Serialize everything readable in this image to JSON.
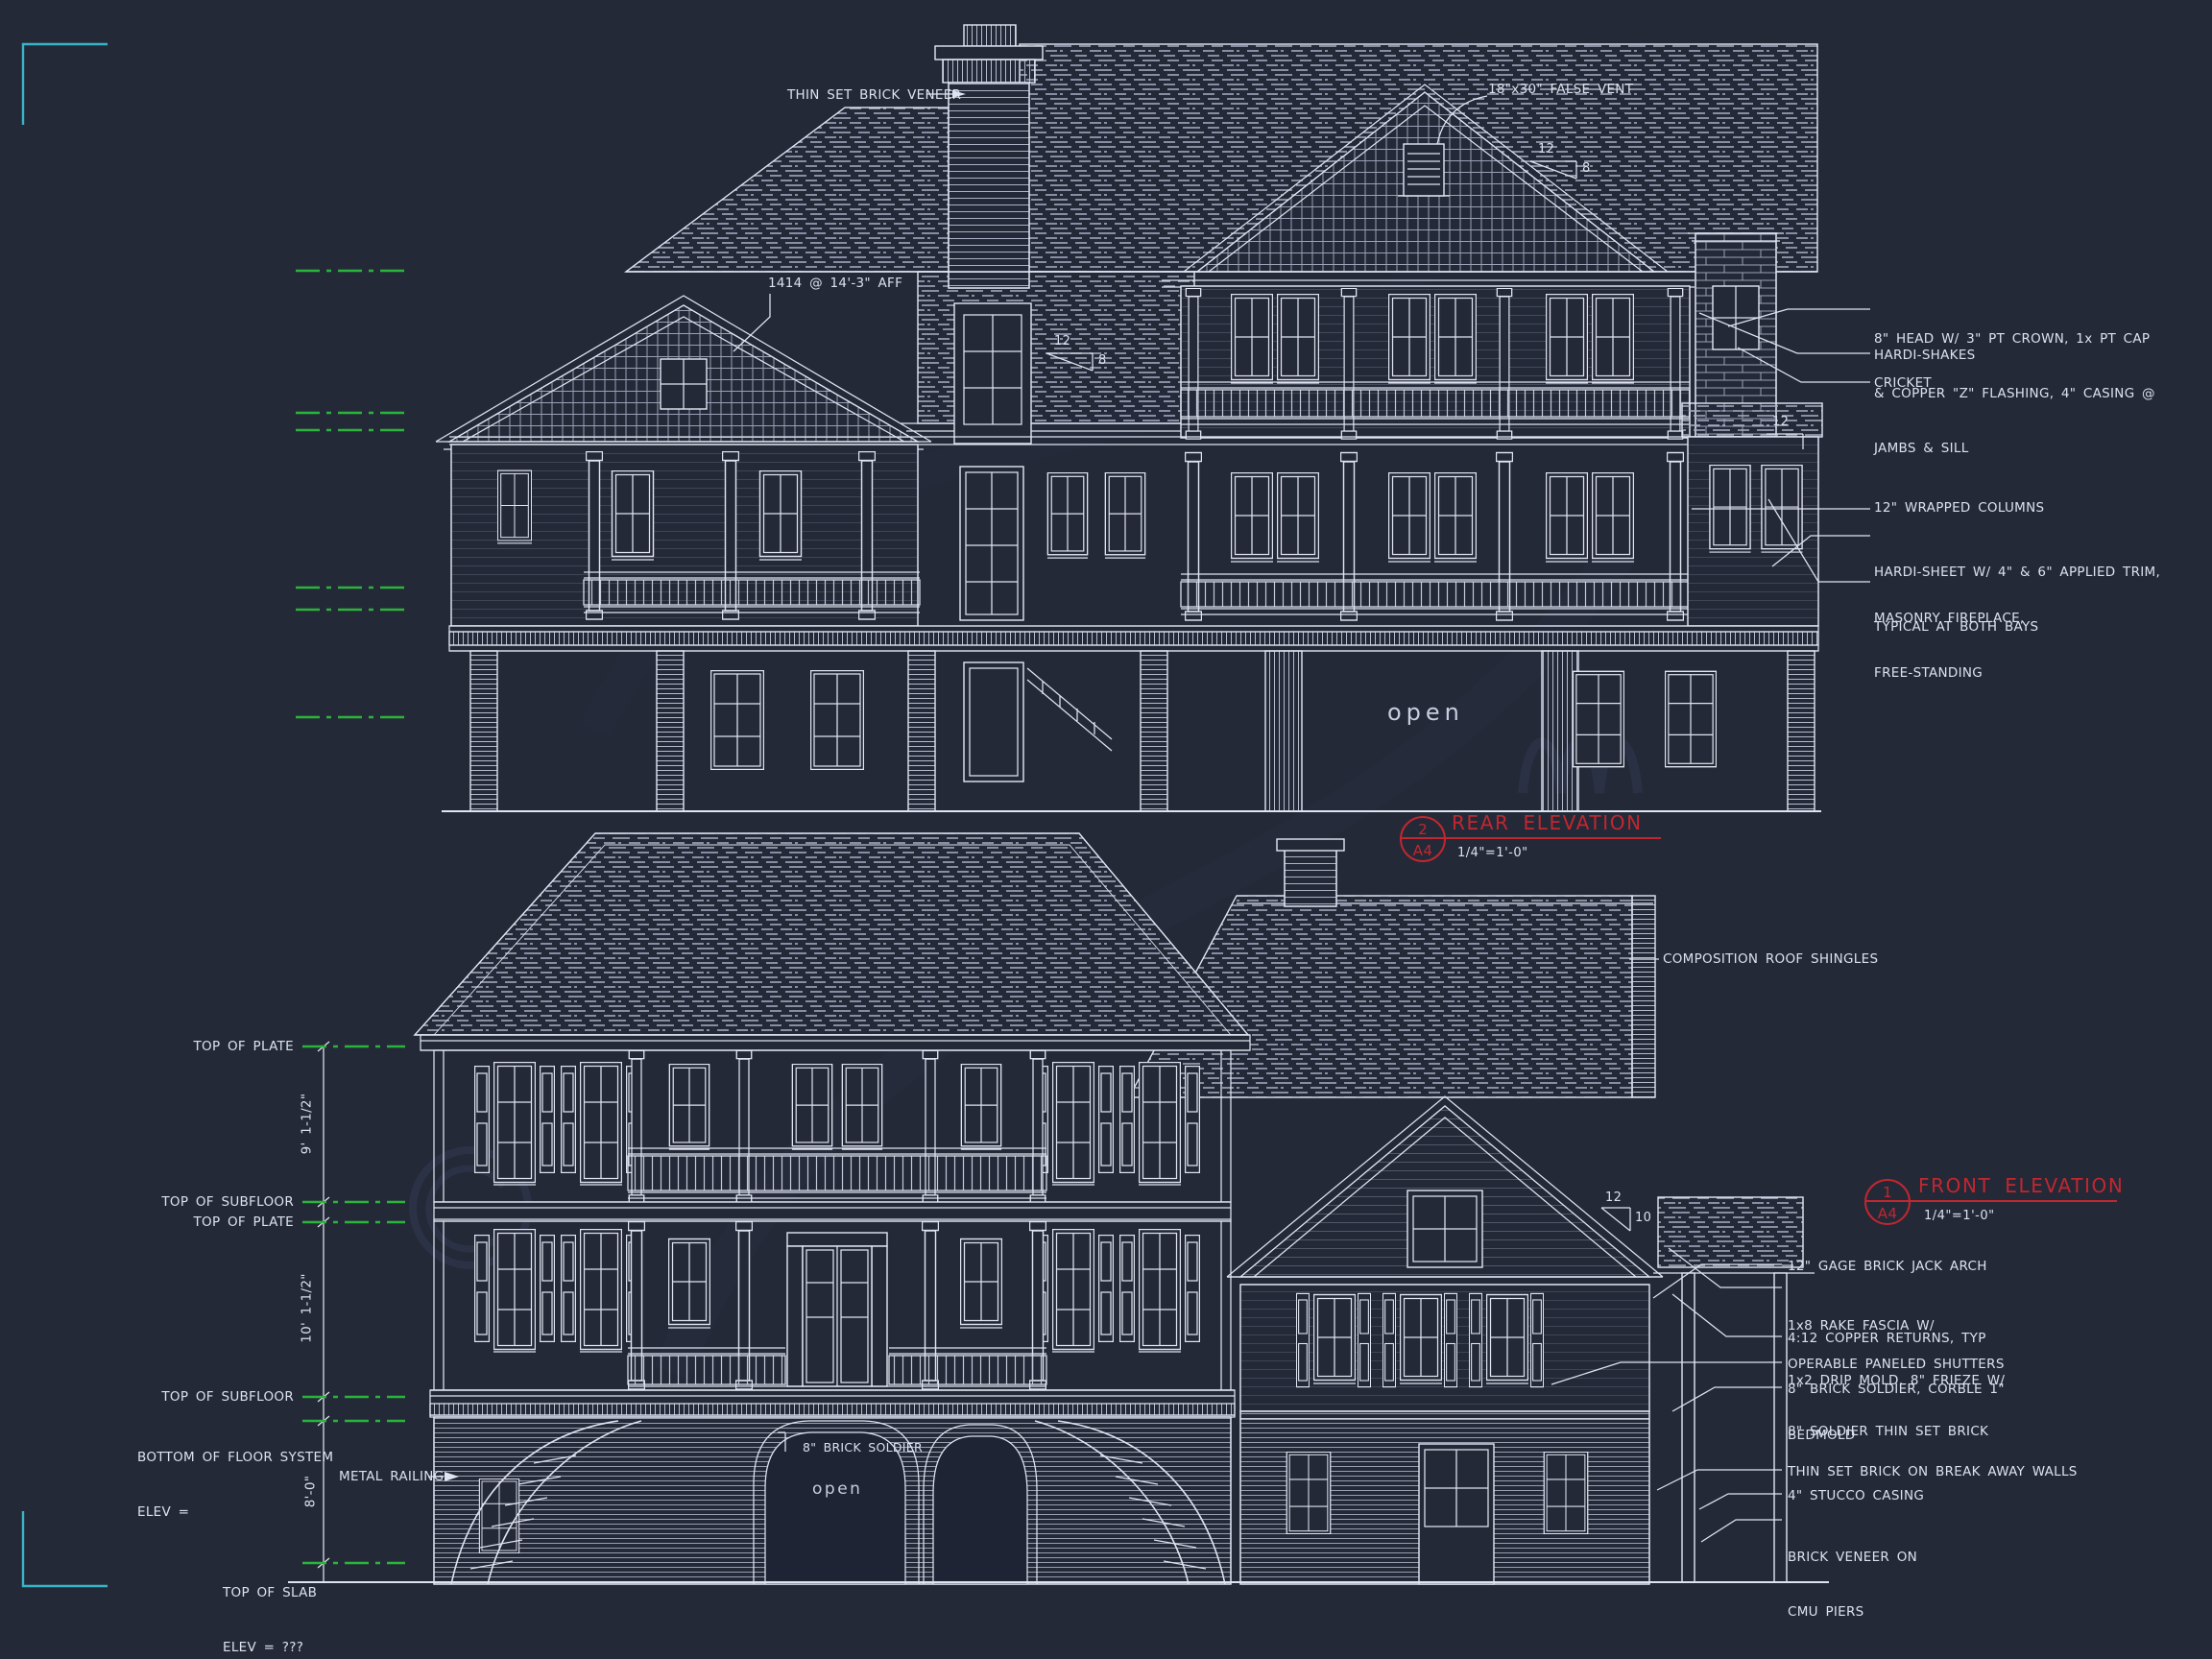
{
  "colors": {
    "background": "#242938",
    "ink": "#dfe4f0",
    "hatch": "#a7aec2",
    "datum_green": "#2bb43b",
    "title_red": "#c1272f",
    "corner_teal": "#38b4c8"
  },
  "rear": {
    "notes": {
      "brick_veneer": "THIN SET BRICK VENEER",
      "false_vent": "18\"x30\" FALSE VENT",
      "aff": "1414 @ 14'-3\" AFF",
      "open": "open"
    },
    "slopes": {
      "left_rise": "12",
      "left_run": "8",
      "top_rise": "12",
      "top_run": "8",
      "right_rise": "12"
    },
    "callouts": [
      {
        "lines": [
          "8\" HEAD W/ 3\" PT CROWN, 1x PT CAP",
          "& COPPER \"Z\" FLASHING, 4\" CASING @",
          "JAMBS & SILL"
        ]
      },
      {
        "lines": [
          "HARDI-SHAKES"
        ]
      },
      {
        "lines": [
          "CRICKET"
        ]
      },
      {
        "lines": [
          "12\" WRAPPED COLUMNS"
        ]
      },
      {
        "lines": [
          "HARDI-SHEET W/ 4\" & 6\" APPLIED TRIM,",
          "TYPICAL AT BOTH BAYS"
        ]
      },
      {
        "lines": [
          "MASONRY FIREPLACE,",
          "FREE-STANDING"
        ]
      }
    ],
    "title": {
      "number": "2",
      "sheet": "A4",
      "name": "REAR ELEVATION",
      "scale": "1/4\"=1'-0\""
    }
  },
  "front": {
    "notes": {
      "roof": "COMPOSITION ROOF SHINGLES",
      "railing": "METAL RAILING",
      "soldier": "8\" BRICK SOLDIER",
      "open": "open"
    },
    "slopes": {
      "rise": "12",
      "run": "10"
    },
    "levels": {
      "plate_upper": "TOP OF PLATE",
      "subfloor_upper": "TOP OF SUBFLOOR",
      "plate_main": "TOP OF PLATE",
      "subfloor_main": "TOP OF SUBFLOOR",
      "bottom_floor_line1": "BOTTOM OF FLOOR SYSTEM",
      "bottom_floor_line2": "ELEV =",
      "slab_line1": "TOP OF SLAB",
      "slab_line2": "ELEV = ???"
    },
    "dims": {
      "upper": "9' 1-1/2\"",
      "middle": "10' 1-1/2\"",
      "lower": "8'-0\""
    },
    "callouts": [
      {
        "lines": [
          "12\" GAGE BRICK JACK ARCH"
        ]
      },
      {
        "lines": [
          "1x8 RAKE FASCIA W/",
          "1x2 DRIP MOLD, 8\" FRIEZE W/",
          "BEDMOLD"
        ]
      },
      {
        "lines": [
          "4:12 COPPER RETURNS, TYP"
        ]
      },
      {
        "lines": [
          "OPERABLE PANELED SHUTTERS"
        ]
      },
      {
        "lines": [
          "8\" BRICK SOLDIER, CORBLE 1\""
        ]
      },
      {
        "lines": [
          "8\" SOLDIER THIN SET BRICK"
        ]
      },
      {
        "lines": [
          "THIN SET BRICK ON BREAK AWAY WALLS"
        ]
      },
      {
        "lines": [
          "4\" STUCCO CASING"
        ]
      },
      {
        "lines": [
          "BRICK VENEER ON",
          "CMU PIERS"
        ]
      }
    ],
    "title": {
      "number": "1",
      "sheet": "A4",
      "name": "FRONT ELEVATION",
      "scale": "1/4\"=1'-0\""
    }
  }
}
